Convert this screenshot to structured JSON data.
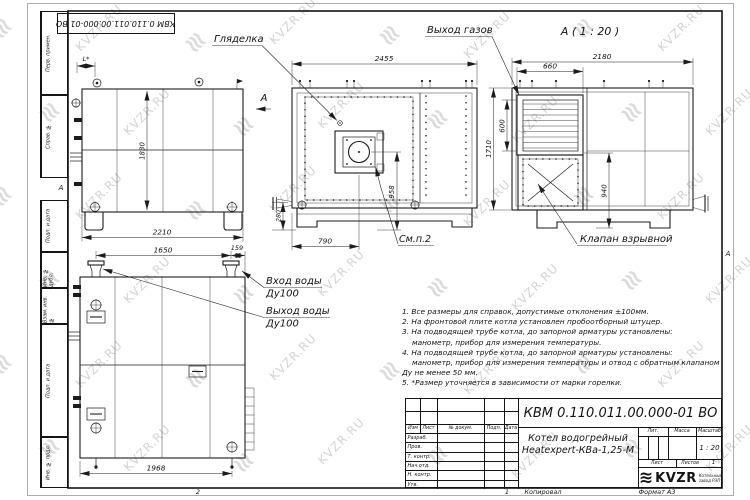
{
  "watermark": {
    "text": "KVZR.RU",
    "text_color": "#d4d4d4",
    "logo_color": "#dcdcdc"
  },
  "page": {
    "doc_number": "КВМ 0.110.011.00.000-01 ВО",
    "zone_a": "А",
    "side_stamps": [
      "Перв. примен.",
      "Справ. №",
      "Подп. и дата",
      "Инв. № дубл.",
      "Взам. инв. №",
      "Подп. и дата",
      "Инв. № подл."
    ],
    "footer": {
      "fold_num": "2",
      "copy_num": "1",
      "kopiroval": "Копировал",
      "format": "Формат А3"
    }
  },
  "views": {
    "side": {
      "dim_l": "L*",
      "dim_height": "1830",
      "dim_length": "2210",
      "section_mark": "А"
    },
    "front": {
      "label_sight": "Гляделка",
      "dim_width": "2455",
      "dim_burner_h": "958",
      "dim_flange_h": "280",
      "dim_burner_x": "790",
      "label_see": "См.п.2"
    },
    "rear": {
      "title": "А ( 1 : 20 )",
      "label_gas": "Выход газов",
      "dim_width": "2180",
      "dim_louver_w": "660",
      "dim_louver_h": "600",
      "dim_height": "1710",
      "dim_valve_h": "940",
      "label_valve": "Клапан взрывной"
    },
    "plan": {
      "dim_span": "1650",
      "dim_offset": "159",
      "dim_length": "1968",
      "label_in": "Вход воды",
      "label_in_dn": "Ду100",
      "label_out": "Выход воды",
      "label_out_dn": "Ду100"
    }
  },
  "notes": [
    "1. Все размеры для справок, допустимые отклонения ±100мм.",
    "2. На фронтовой плите котла установлен пробоотборный штуцер.",
    "3. На подводящей трубе котла, до запорной арматуры установлены:",
    "манометр, прибор для измерения температуры.",
    "4. На подводящей трубе котла, до запорной арматуры установлены:",
    "манометр, прибор для измерения температуры и отвод с обратным клапаном",
    "Ду не менее 50 мм.",
    "5. *Размер уточняется в зависимости от марки горелки."
  ],
  "title_block": {
    "doc_number": "КВМ 0.110.011.00.000-01 ВО",
    "name_line1": "Котел водогрейный",
    "name_line2": "Heatexpert-КВа-1,25-М",
    "cols": {
      "izm": "Изм",
      "list": "Лист",
      "doc": "№ докум.",
      "podp": "Подп.",
      "data": "Дата"
    },
    "rows": [
      "Разраб.",
      "Пров.",
      "Т. контр.",
      "Нач.отд.",
      "Н. контр.",
      "Утв."
    ],
    "lit_label": "Лит.",
    "mass_label": "Масса",
    "scale_label": "Масштаб",
    "scale_value": "1 : 20",
    "sheet_label": "Лист",
    "sheets_label": "Листов",
    "sheets_value": "1",
    "logo_coil": "≋",
    "logo_word": "KVZR",
    "logo_sub1": "Котельный",
    "logo_sub2": "завод РЭП"
  }
}
